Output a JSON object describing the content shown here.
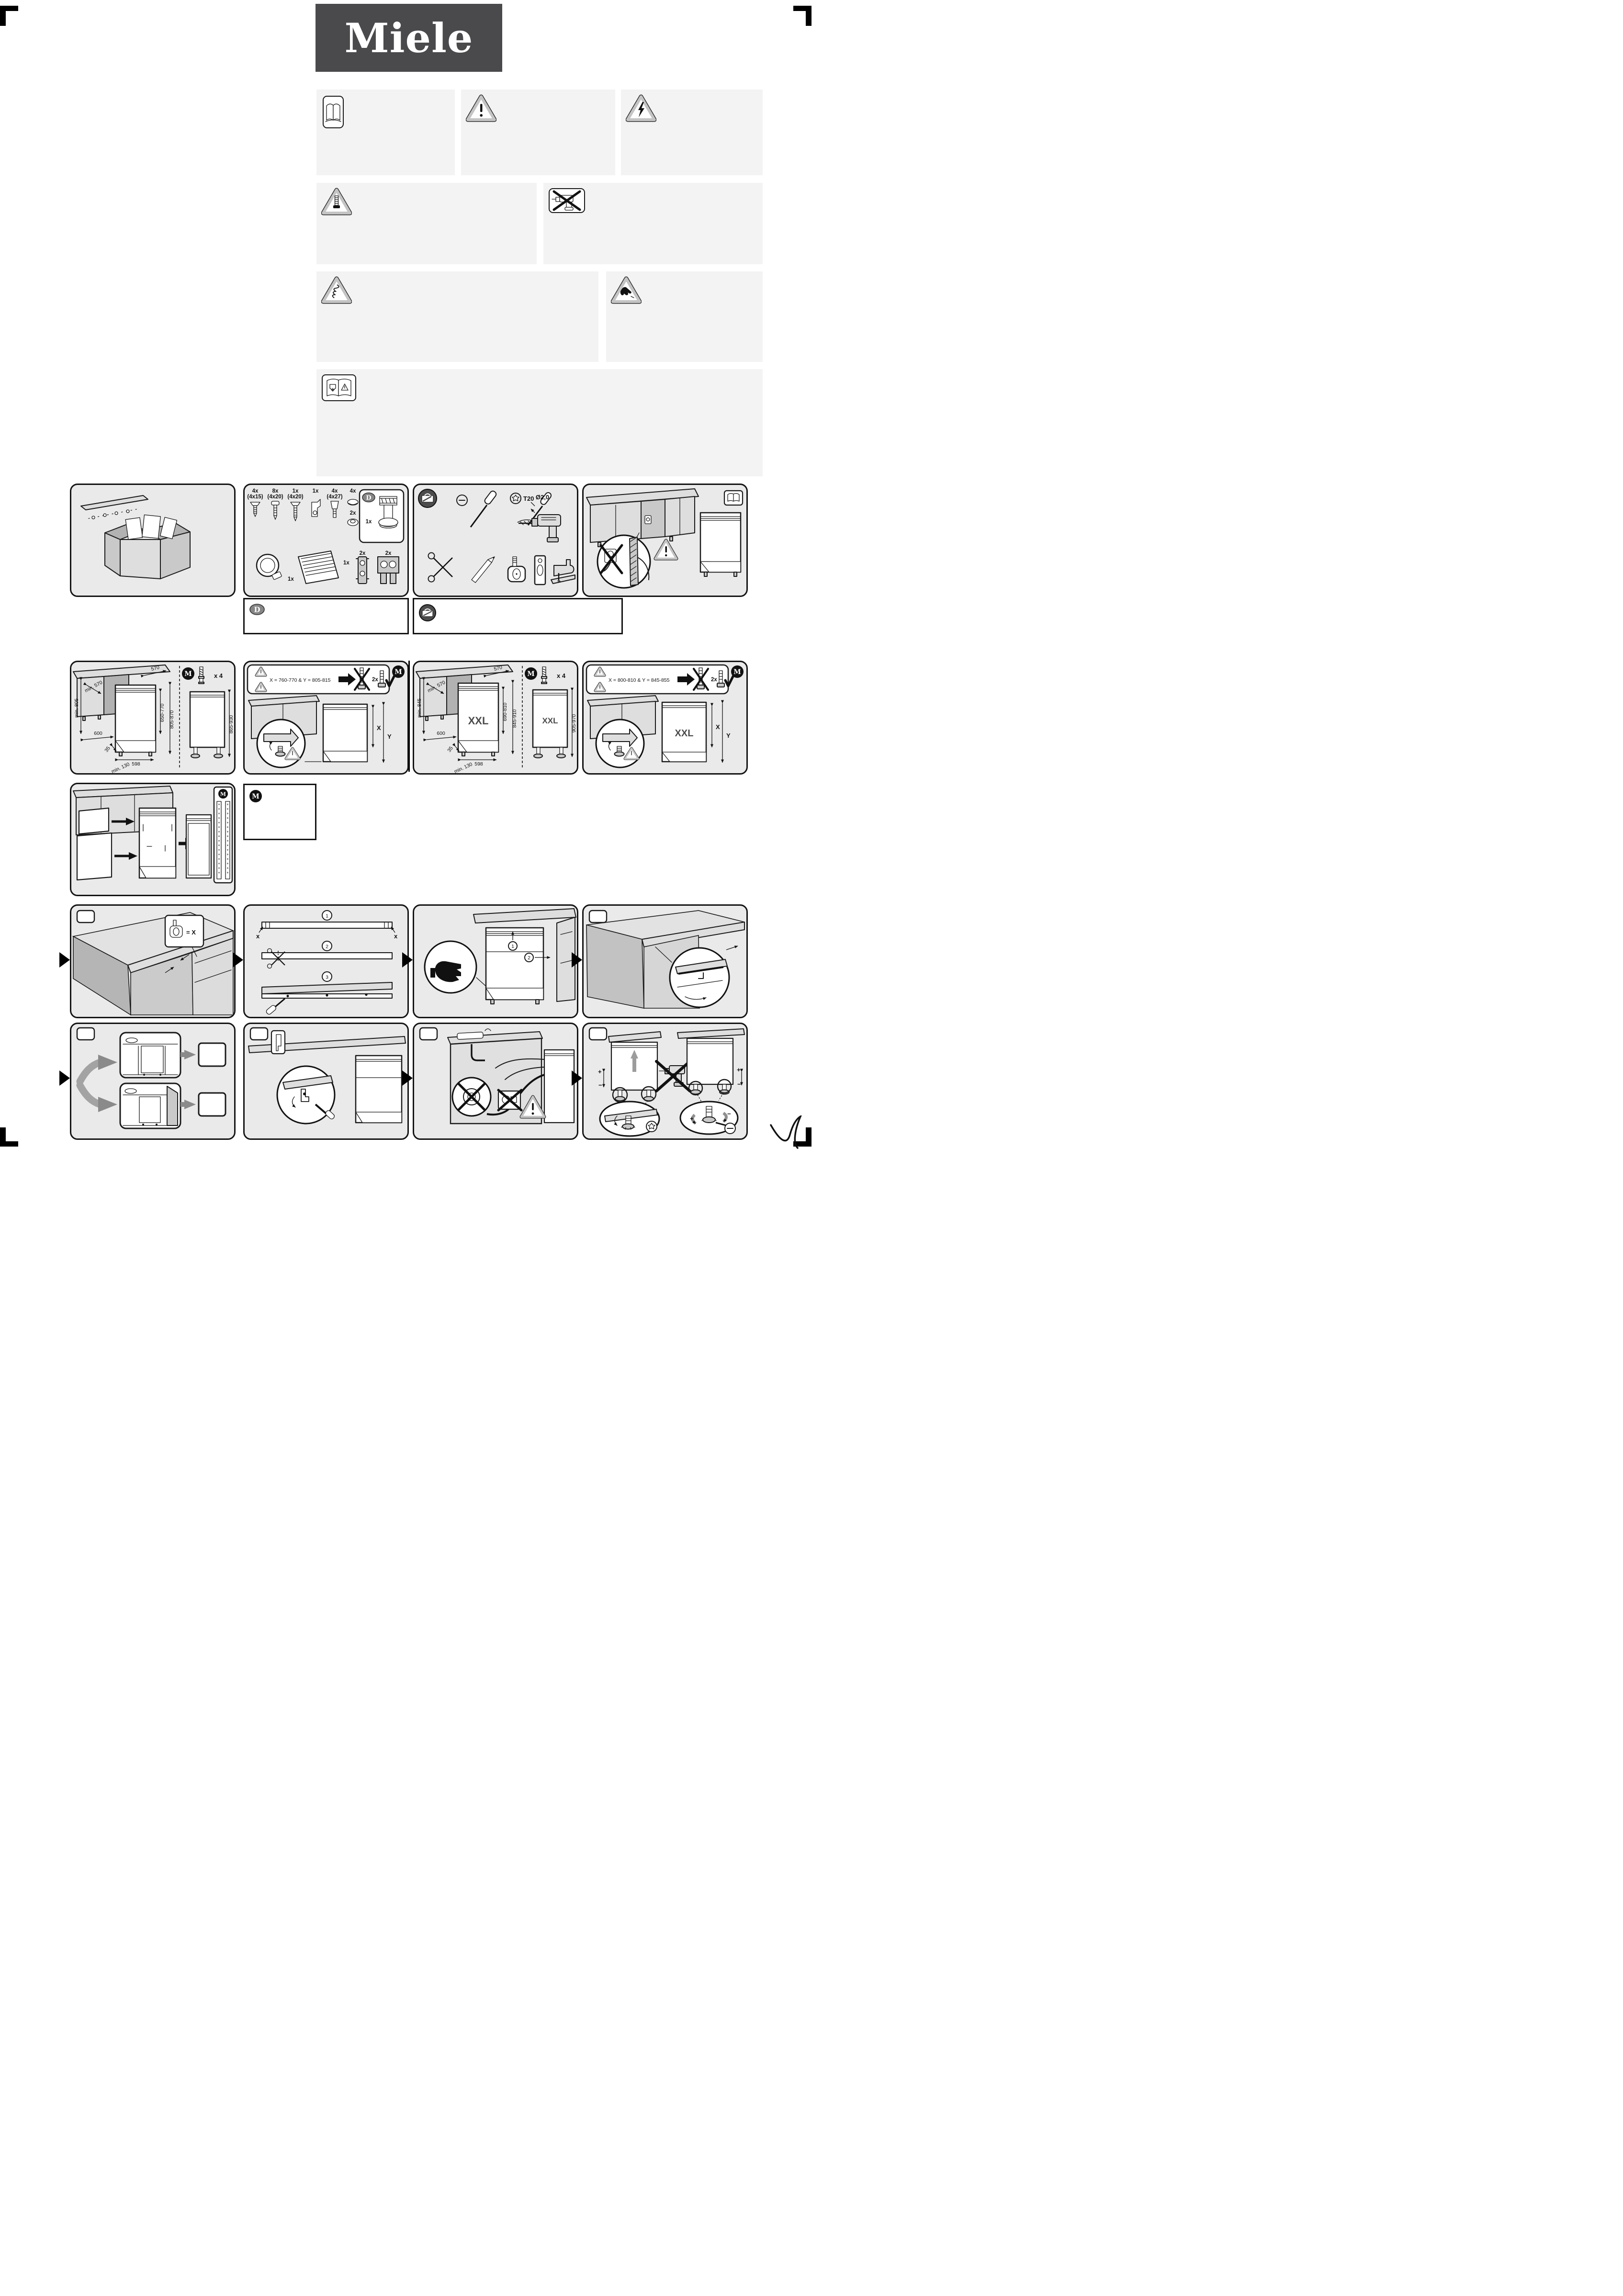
{
  "logo": {
    "text": "Miele"
  },
  "badges": {
    "m": "M",
    "d": "D"
  },
  "parts": {
    "items": [
      {
        "count": "4x",
        "size": "(4x15)"
      },
      {
        "count": "8x",
        "size": "(4x20)"
      },
      {
        "count": "1x",
        "size": "(4x20)"
      },
      {
        "count": "1x",
        "size": ""
      },
      {
        "count": "4x",
        "size": "(4x27)"
      },
      {
        "count": "4x",
        "size": ""
      }
    ],
    "grommet_count": "2x",
    "adapter_count": "1x",
    "clamp_count": "1x",
    "grille_count": "1x",
    "bracket_small_count": "2x",
    "bracket_wide_count": "2x"
  },
  "tools": {
    "torx_label": "T20",
    "drill_label": "Ø2,0"
  },
  "dims_standard": {
    "niche_height": "min. 805",
    "cabinet_depth": "min. 570",
    "niche_width": "600",
    "counter_depth": "570",
    "door_height": "650-770",
    "front_height": "805-870",
    "width": "598",
    "plinth_depth": "35",
    "plinth_height": "min. 130",
    "overall_height": "865-930",
    "feet_count": "x 4"
  },
  "callout_standard": {
    "formula": "X = 760-770 & Y = 805-815",
    "screw_count": "2x",
    "x_label": "X",
    "y_label": "Y"
  },
  "dims_xxl": {
    "niche_height": "min. 845",
    "cabinet_depth": "min. 570",
    "niche_width": "600",
    "counter_depth": "570",
    "door_height": "690-810",
    "front_height": "845-910",
    "width": "598",
    "plinth_depth": "35",
    "plinth_height": "min. 130",
    "overall_height": "905-970",
    "feet_count": "x 4",
    "xxl_label": "XXL"
  },
  "callout_xxl": {
    "formula": "X = 800-810 & Y = 845-855",
    "screw_count": "2x",
    "x_label": "X",
    "y_label": "Y",
    "xxl_label": "XXL"
  },
  "steps_a": {
    "measure_label": "= X",
    "s1": "1",
    "s2": "2",
    "s3": "3",
    "x_left": "x",
    "x_right": "x",
    "lift": "1",
    "push": "2"
  },
  "leveling": {
    "plus": "+",
    "minus": "−"
  }
}
